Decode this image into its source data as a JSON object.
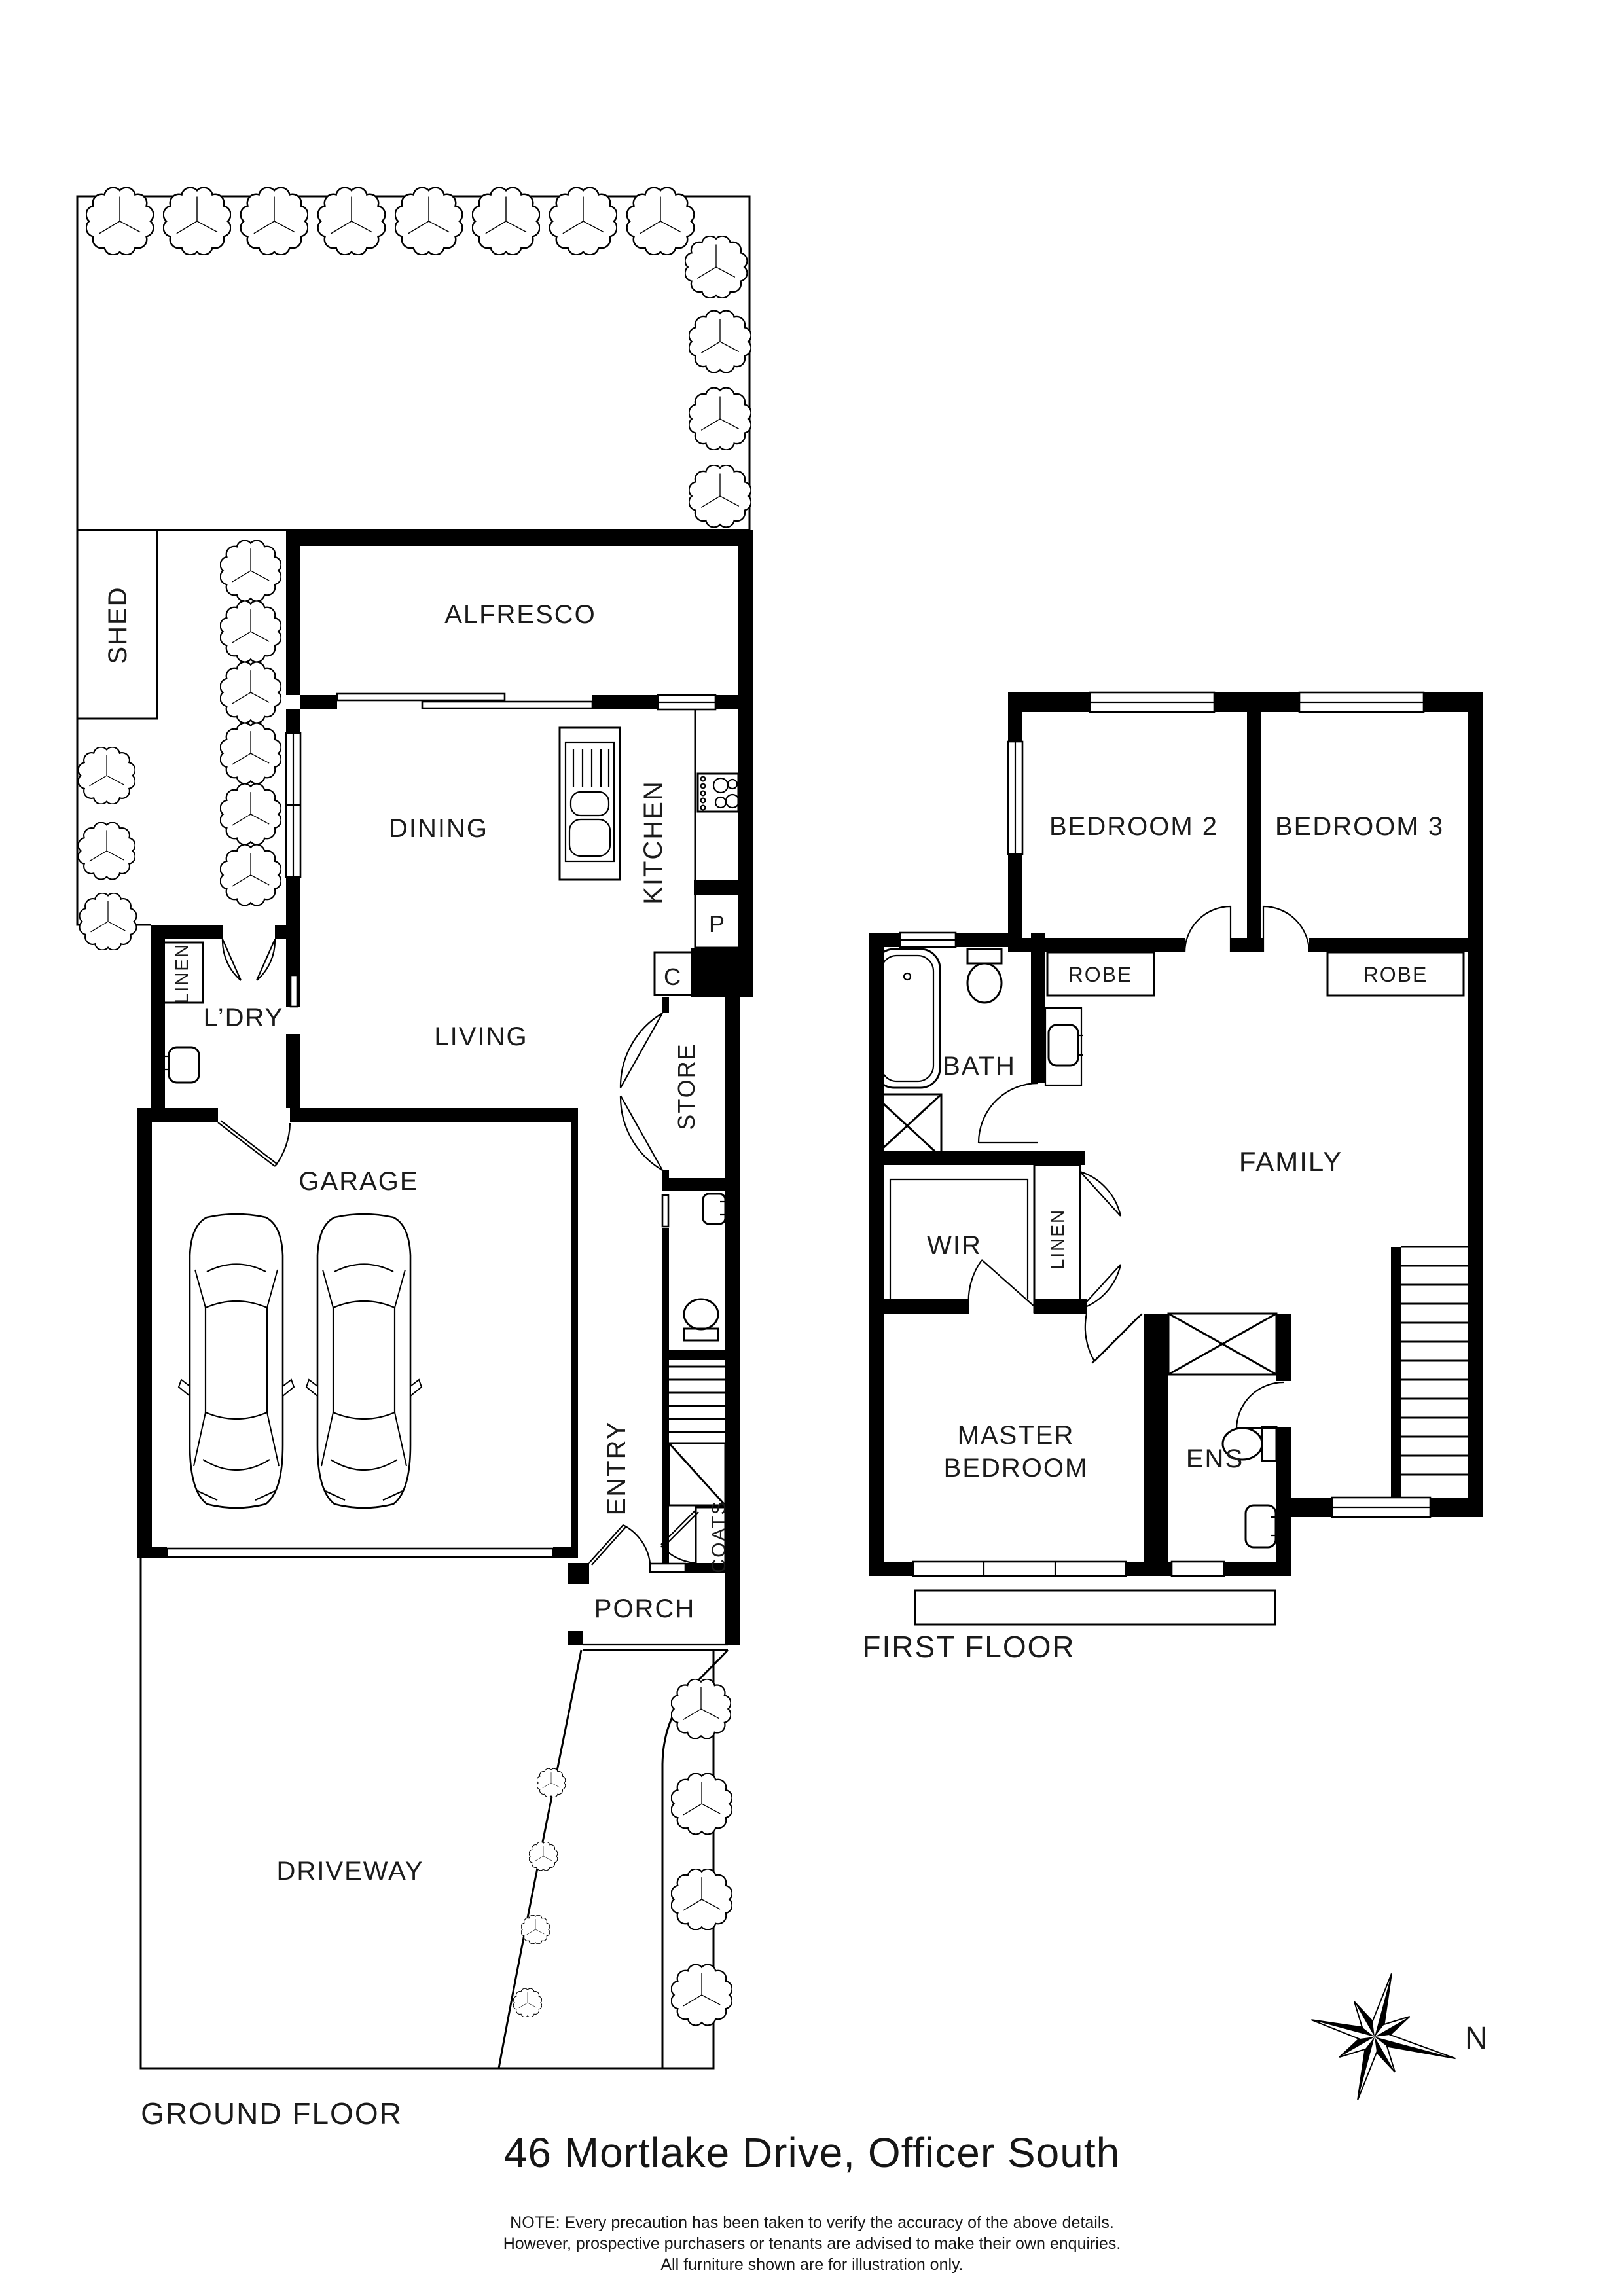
{
  "page": {
    "title": "46 Mortlake Drive, Officer South",
    "compass_north": "N",
    "note_lines": [
      "NOTE: Every precaution has been taken to verify the accuracy of the above details.",
      "However, prospective purchasers or tenants are advised to make their own enquiries.",
      "All furniture shown are for illustration only."
    ]
  },
  "ground_floor": {
    "label": "GROUND FLOOR",
    "rooms": {
      "shed": "SHED",
      "alfresco": "ALFRESCO",
      "dining": "DINING",
      "kitchen": "KITCHEN",
      "pantry": "P",
      "cupboard": "C",
      "linen": "LINEN",
      "laundry": "L’DRY",
      "living": "LIVING",
      "store": "STORE",
      "garage": "GARAGE",
      "entry": "ENTRY",
      "coats": "COATS",
      "porch": "PORCH",
      "driveway": "DRIVEWAY"
    }
  },
  "first_floor": {
    "label": "FIRST FLOOR",
    "rooms": {
      "bedroom2": "BEDROOM 2",
      "bedroom3": "BEDROOM 3",
      "robe2": "ROBE",
      "robe3": "ROBE",
      "bath": "BATH",
      "family": "FAMILY",
      "wir": "WIR",
      "linen": "LINEN",
      "master_line1": "MASTER",
      "master_line2": "BEDROOM",
      "ensuite": "ENS"
    }
  }
}
